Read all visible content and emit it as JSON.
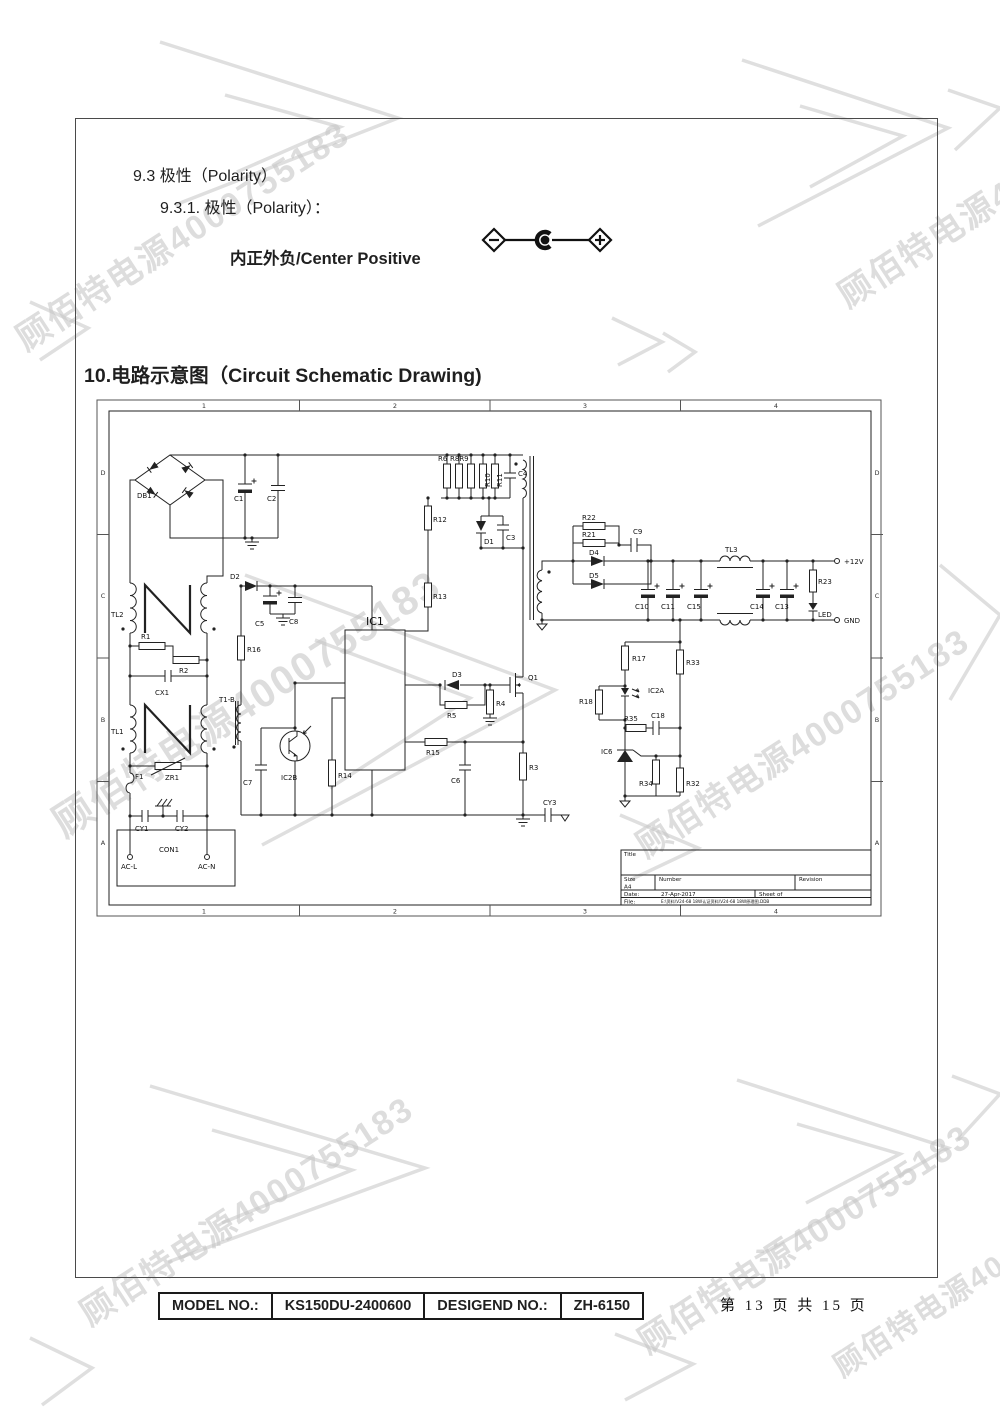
{
  "header": {
    "section_9_3": "9.3 极性（Polarity）",
    "section_9_3_1": "9.3.1.  极性（Polarity）：",
    "polarity_text": "内正外负/Center Positive",
    "section_10": "10.电路示意图（Circuit Schematic Drawing)"
  },
  "watermark": {
    "text": "顾佰特电源4000755183",
    "color": "#c7c7c7"
  },
  "schematic": {
    "grid_cols": [
      "1",
      "2",
      "3",
      "4"
    ],
    "grid_rows": [
      "D",
      "C",
      "B",
      "A"
    ],
    "title_block": {
      "title_label": "Title",
      "size_label": "Size",
      "size_value": "A4",
      "number_label": "Number",
      "revision_label": "Revision",
      "date_label": "Date:",
      "date_value": "27-Apr-2017",
      "sheet_label": "Sheet  of",
      "file_label": "File:",
      "file_value": "E:\\资料\\V24-68 18W认证资料\\V24-68 18W原理图.DDB"
    },
    "labels": [
      {
        "t": "DB1",
        "x": 42,
        "y": 100
      },
      {
        "t": "C1",
        "x": 139,
        "y": 103
      },
      {
        "t": "C2",
        "x": 172,
        "y": 103
      },
      {
        "t": "R6",
        "x": 343,
        "y": 63
      },
      {
        "t": "R8R9",
        "x": 355,
        "y": 63
      },
      {
        "t": "R10",
        "x": 395,
        "y": 89,
        "r": -90
      },
      {
        "t": "R11",
        "x": 407,
        "y": 89,
        "r": -90
      },
      {
        "t": "C4",
        "x": 423,
        "y": 78
      },
      {
        "t": "R12",
        "x": 338,
        "y": 124
      },
      {
        "t": "D1",
        "x": 389,
        "y": 146
      },
      {
        "t": "C3",
        "x": 411,
        "y": 142
      },
      {
        "t": "R13",
        "x": 338,
        "y": 201
      },
      {
        "t": "IC1",
        "x": 271,
        "y": 227,
        "fs": 11
      },
      {
        "t": "D2",
        "x": 135,
        "y": 181
      },
      {
        "t": "C5",
        "x": 160,
        "y": 228
      },
      {
        "t": "C8",
        "x": 194,
        "y": 226
      },
      {
        "t": "R16",
        "x": 152,
        "y": 254
      },
      {
        "t": "TL2",
        "x": 16,
        "y": 219
      },
      {
        "t": "R1",
        "x": 46,
        "y": 241
      },
      {
        "t": "R2",
        "x": 84,
        "y": 275
      },
      {
        "t": "CX1",
        "x": 60,
        "y": 297
      },
      {
        "t": "TL1",
        "x": 16,
        "y": 336
      },
      {
        "t": "T1-B",
        "x": 124,
        "y": 304
      },
      {
        "t": "ZR1",
        "x": 70,
        "y": 382
      },
      {
        "t": "F1",
        "x": 40,
        "y": 381
      },
      {
        "t": "CY1",
        "x": 40,
        "y": 433
      },
      {
        "t": "CY2",
        "x": 80,
        "y": 433
      },
      {
        "t": "CON1",
        "x": 64,
        "y": 454
      },
      {
        "t": "AC-L",
        "x": 26,
        "y": 471
      },
      {
        "t": "AC-N",
        "x": 103,
        "y": 471
      },
      {
        "t": "IC2B",
        "x": 186,
        "y": 382
      },
      {
        "t": "C7",
        "x": 148,
        "y": 387
      },
      {
        "t": "R14",
        "x": 243,
        "y": 380
      },
      {
        "t": "D3",
        "x": 357,
        "y": 279
      },
      {
        "t": "R5",
        "x": 352,
        "y": 320
      },
      {
        "t": "R4",
        "x": 401,
        "y": 308
      },
      {
        "t": "Q1",
        "x": 433,
        "y": 282
      },
      {
        "t": "R15",
        "x": 331,
        "y": 357
      },
      {
        "t": "C6",
        "x": 356,
        "y": 385
      },
      {
        "t": "R3",
        "x": 434,
        "y": 372
      },
      {
        "t": "CY3",
        "x": 448,
        "y": 407
      },
      {
        "t": "R22",
        "x": 487,
        "y": 122
      },
      {
        "t": "R21",
        "x": 487,
        "y": 139
      },
      {
        "t": "C9",
        "x": 538,
        "y": 136
      },
      {
        "t": "D4",
        "x": 494,
        "y": 157
      },
      {
        "t": "D5",
        "x": 494,
        "y": 180
      },
      {
        "t": "TL3",
        "x": 630,
        "y": 154
      },
      {
        "t": "+12V",
        "x": 749,
        "y": 166
      },
      {
        "t": "GND",
        "x": 749,
        "y": 225
      },
      {
        "t": "C10",
        "x": 540,
        "y": 211
      },
      {
        "t": "C11",
        "x": 566,
        "y": 211
      },
      {
        "t": "C15",
        "x": 592,
        "y": 211
      },
      {
        "t": "C14",
        "x": 655,
        "y": 211
      },
      {
        "t": "C13",
        "x": 680,
        "y": 211
      },
      {
        "t": "R23",
        "x": 723,
        "y": 186
      },
      {
        "t": "LED",
        "x": 723,
        "y": 219
      },
      {
        "t": "R17",
        "x": 537,
        "y": 263
      },
      {
        "t": "R33",
        "x": 591,
        "y": 267
      },
      {
        "t": "R18",
        "x": 484,
        "y": 306
      },
      {
        "t": "IC2A",
        "x": 553,
        "y": 295
      },
      {
        "t": "R35",
        "x": 529,
        "y": 323
      },
      {
        "t": "C18",
        "x": 556,
        "y": 320
      },
      {
        "t": "IC6",
        "x": 506,
        "y": 356
      },
      {
        "t": "R34",
        "x": 544,
        "y": 388
      },
      {
        "t": "R32",
        "x": 591,
        "y": 388
      }
    ]
  },
  "footer": {
    "model_label": "MODEL NO.:",
    "model_value": "KS150DU-2400600",
    "design_label": "DESIGEND NO.:",
    "design_value": "ZH-6150",
    "page_info": "第 13 页 共 15 页"
  }
}
